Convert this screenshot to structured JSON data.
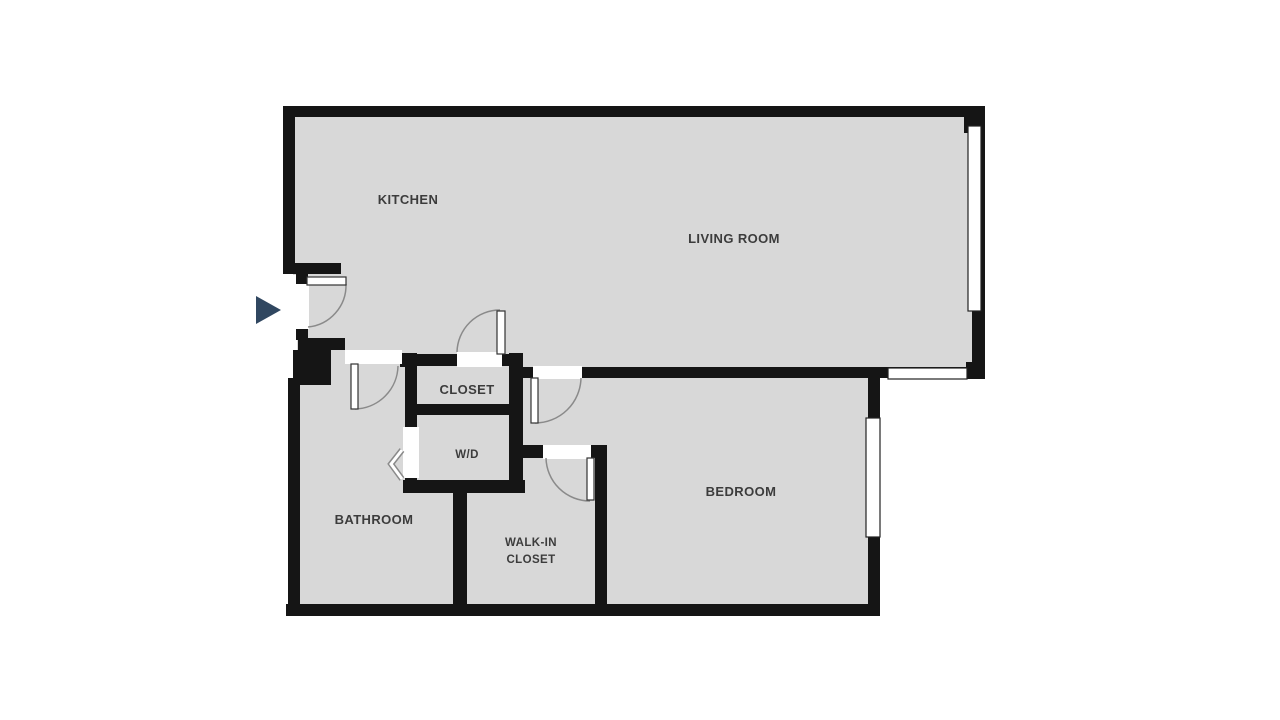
{
  "plan": {
    "rooms": {
      "kitchen": {
        "label": "KITCHEN"
      },
      "living_room": {
        "label": "LIVING ROOM"
      },
      "closet": {
        "label": "CLOSET"
      },
      "washer_dryer": {
        "label": "W/D"
      },
      "bathroom": {
        "label": "BATHROOM"
      },
      "walk_in_closet": {
        "label_line1": "WALK-IN",
        "label_line2": "CLOSET"
      },
      "bedroom": {
        "label": "BEDROOM"
      }
    },
    "icons": {
      "entry_arrow": "right-pointing-triangle-entry-marker",
      "bifold_door": "chevron-bifold-door-symbol"
    }
  },
  "colors": {
    "background": "#ffffff",
    "floor": "#d8d8d8",
    "wall": "#151515",
    "door_arc": "#8a8a8a",
    "label_text": "#3c3c3c",
    "entry_arrow": "#304760",
    "window_border": "#222222"
  }
}
